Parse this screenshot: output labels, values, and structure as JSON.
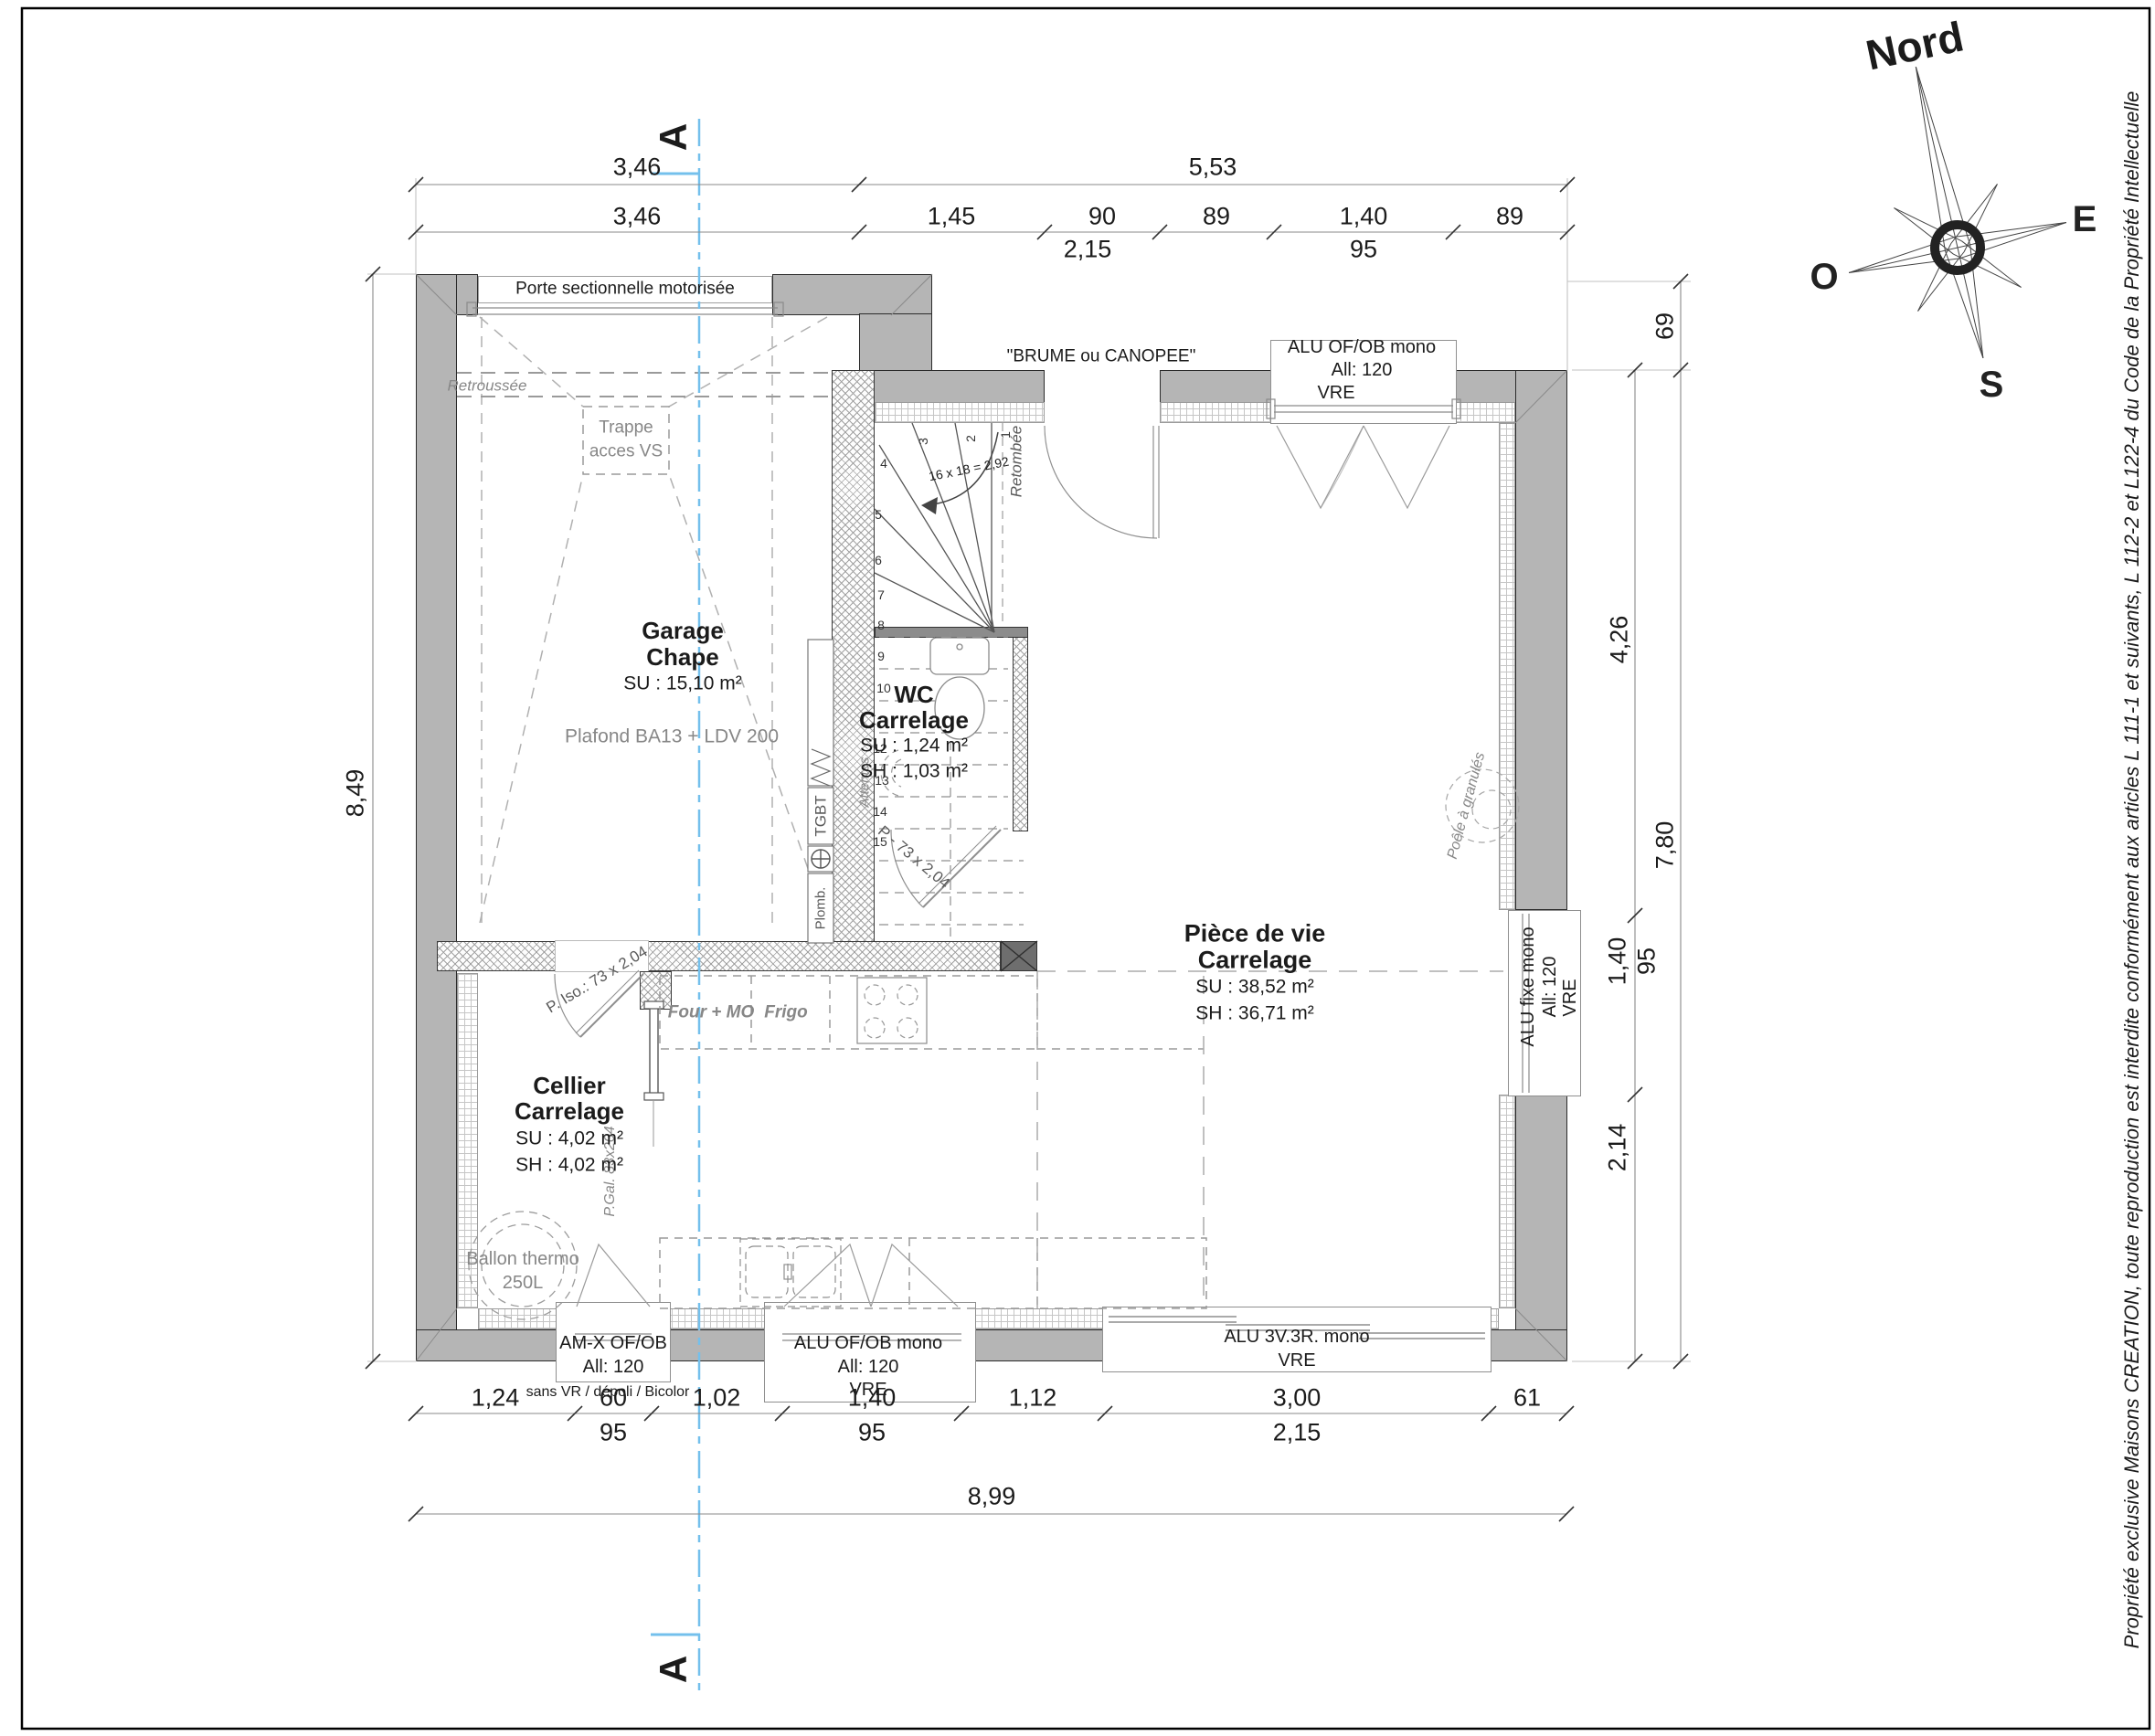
{
  "compass": {
    "north_label": "Nord",
    "east_label": "E",
    "west_label": "O",
    "south_label": "S"
  },
  "copyright_text": "Propriété exclusive Maisons CREATION, toute reproduction est interdite conformément aux articles L 111-1 et suivants, L 112-2 et L122-4 du Code de la Propriété Intellectuelle",
  "section": {
    "marker_top": "A",
    "marker_bottom": "A"
  },
  "dimensions": {
    "top_row1": [
      "3,46",
      "5,53"
    ],
    "top_row2": [
      "3,46",
      "1,45",
      "90",
      "89",
      "1,40",
      "89"
    ],
    "top_row3": [
      "2,15",
      "95"
    ],
    "bottom_row1": [
      "1,24",
      "60",
      "1,02",
      "1,40",
      "1,12",
      "3,00",
      "61"
    ],
    "bottom_row2": [
      "95",
      "95",
      "2,15"
    ],
    "bottom_total": "8,99",
    "left_total": "8,49",
    "right_inner": [
      "4,26",
      "1,40",
      "95",
      "2,14"
    ],
    "right_outer": [
      "69",
      "7,80"
    ]
  },
  "rooms": {
    "garage": {
      "name": "Garage",
      "finish": "Chape",
      "su": "SU : 15,10 m²",
      "ceiling": "Plafond BA13 + LDV 200"
    },
    "wc": {
      "name": "WC",
      "finish": "Carrelage",
      "su": "SU : 1,24 m²",
      "sh": "SH : 1,03 m²"
    },
    "cellier": {
      "name": "Cellier",
      "finish": "Carrelage",
      "su": "SU : 4,02 m²",
      "sh": "SH : 4,02 m²"
    },
    "living": {
      "name": "Pièce de vie",
      "finish": "Carrelage",
      "su": "SU : 38,52 m²",
      "sh": "SH : 36,71 m²"
    }
  },
  "openings": {
    "garage_door": "Porte sectionnelle motorisée",
    "entry_door": "\"BRUME ou CANOPEE\"",
    "window_top": {
      "l1": "ALU OF/OB mono",
      "l2": "All: 120",
      "l3": "VRE"
    },
    "window_right": {
      "l1": "ALU fixe mono",
      "l2": "All: 120",
      "l3": "VRE"
    },
    "window_cellier": {
      "l1": "AM-X OF/OB",
      "l2": "All: 120",
      "note": "sans VR / dépoli / Bicolor"
    },
    "window_kitchen": {
      "l1": "ALU OF/OB mono",
      "l2": "All: 120",
      "l3": "VRE"
    },
    "window_living": {
      "l1": "ALU 3V.3R. mono",
      "l2": "VRE"
    },
    "door_cellier": "P. Iso.: 73 x 2,04",
    "door_wc": "P - 73 x 2,04",
    "door_pocket": "P.Gal. 83x204"
  },
  "annotations": {
    "retroussee": "Retroussée",
    "trappe_l1": "Trappe",
    "trappe_l2": "acces VS",
    "stair_formula": "16 x 18 = 2,92",
    "retombee": "Retombée",
    "attentes": "Attentes",
    "tgbt": "TGBT",
    "plomb": "Plomb.",
    "four": "Four + MO",
    "frigo": "Frigo",
    "ballon_l1": "Ballon thermo",
    "ballon_l2": "250L",
    "poele": "Poêle à granulés"
  },
  "stairs": {
    "numbers": [
      "1",
      "2",
      "3",
      "4",
      "5",
      "6",
      "7",
      "8",
      "9",
      "10",
      "12",
      "13",
      "14",
      "15"
    ]
  }
}
